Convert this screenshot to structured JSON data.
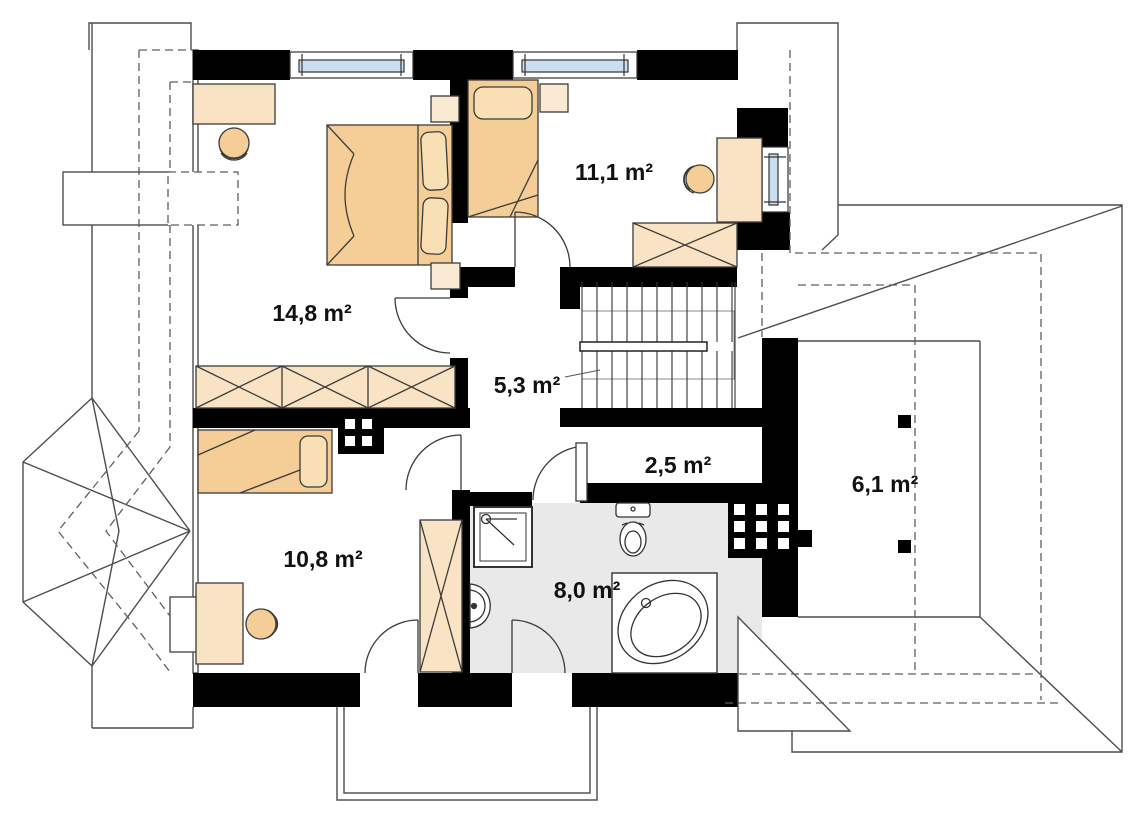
{
  "plan": {
    "title": "attic-floor-plan",
    "units": "m²",
    "rooms": [
      {
        "name": "bedroom-main",
        "area_label": "14,8 m²"
      },
      {
        "name": "bedroom-right",
        "area_label": "11,1 m²"
      },
      {
        "name": "hall",
        "area_label": "5,3 m²"
      },
      {
        "name": "storage",
        "area_label": "2,5 m²"
      },
      {
        "name": "roof-terrace",
        "area_label": "6,1 m²"
      },
      {
        "name": "bedroom-bottom",
        "area_label": "10,8 m²"
      },
      {
        "name": "bathroom",
        "area_label": "8,0 m²"
      }
    ],
    "fixtures": [
      "double-bed",
      "single-bed-right",
      "single-bed-bottom",
      "desk-top-left",
      "desk-right",
      "desk-bottom-left",
      "stool",
      "wardrobe",
      "stairs",
      "balcony",
      "shower",
      "washbasin",
      "toilet",
      "corner-bathtub",
      "chimney"
    ],
    "colors": {
      "wall": "#000000",
      "furniture": "#FAE3C4",
      "furniture_light": "#FBEAD3",
      "bed": "#F5CD96",
      "pillow": "#F9E0B4",
      "window_glass": "#C9DFF1",
      "bathroom_floor": "#E9E9E9",
      "roof_line": "#4d4d4d",
      "dashed_line": "#5f5f5f"
    }
  }
}
